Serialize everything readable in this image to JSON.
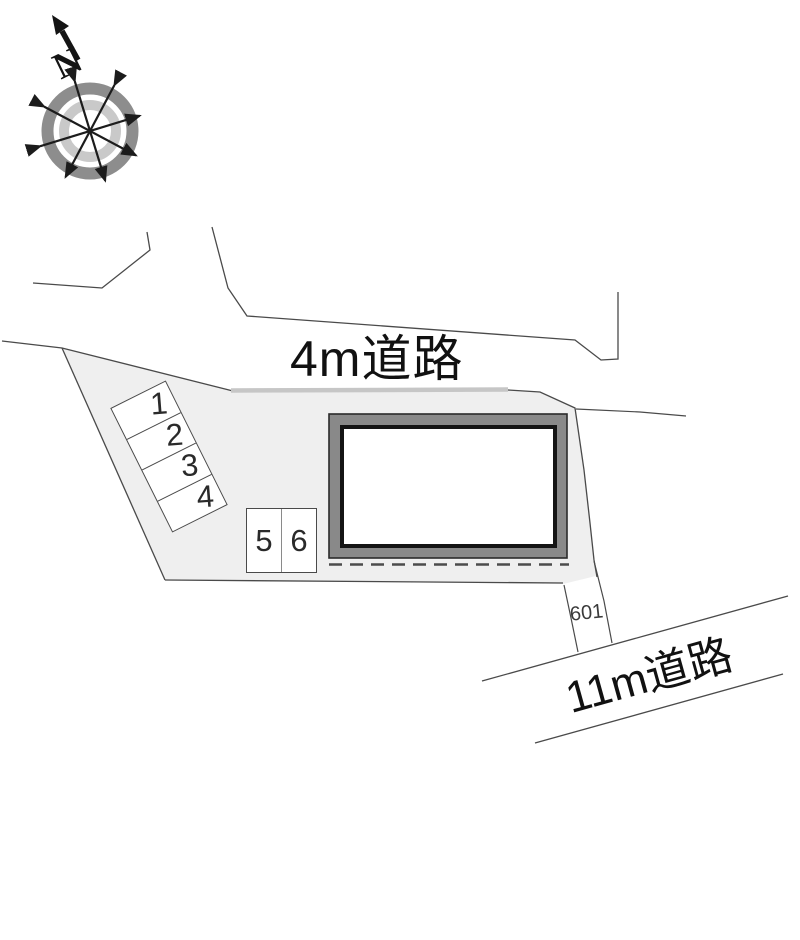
{
  "plan": {
    "type": "residential-site-plan"
  },
  "compass": {
    "north_label": "N"
  },
  "roads": {
    "top": {
      "label": "4m道路"
    },
    "bottom": {
      "label": "11m道路"
    }
  },
  "lot": {
    "number": "601"
  },
  "parking": {
    "stalls": [
      "1",
      "2",
      "3",
      "4",
      "5",
      "6"
    ]
  },
  "colors": {
    "parcel_fill": "#efefef",
    "road_edge": "#c6c6c6",
    "line": "#4a4a4a",
    "building_band": "#898989",
    "building_border": "#1e1e1e",
    "compass_ring_outer": "#8d8d8d",
    "compass_ring_inner": "#c9c9c9",
    "text": "#1a1a1a"
  }
}
